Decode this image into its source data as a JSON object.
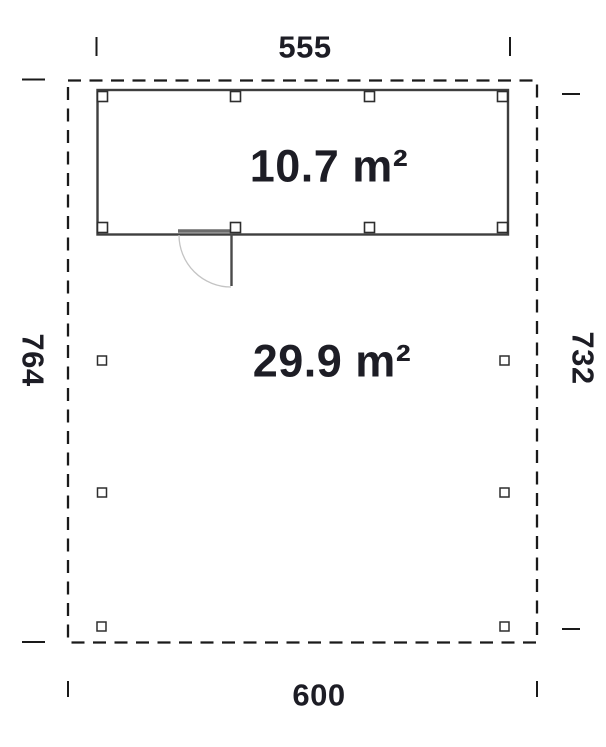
{
  "floor_plan": {
    "background": "#ffffff",
    "text_color": "#1d1d25",
    "line_colors": {
      "boundary": "#1a1a1a",
      "wall": "#3e3e3e",
      "post": "#2e2e2e",
      "door_threshold": "#6b6b6b",
      "door_leaf": "#4a4a4a",
      "door_arc": "#c4c4c4",
      "tick": "#1a1a1a"
    },
    "dimensions": {
      "top": "555",
      "bottom": "600",
      "left": "764",
      "right": "732"
    },
    "areas": {
      "upper_room": "10.7 m²",
      "lower_area": "29.9 m²"
    }
  }
}
